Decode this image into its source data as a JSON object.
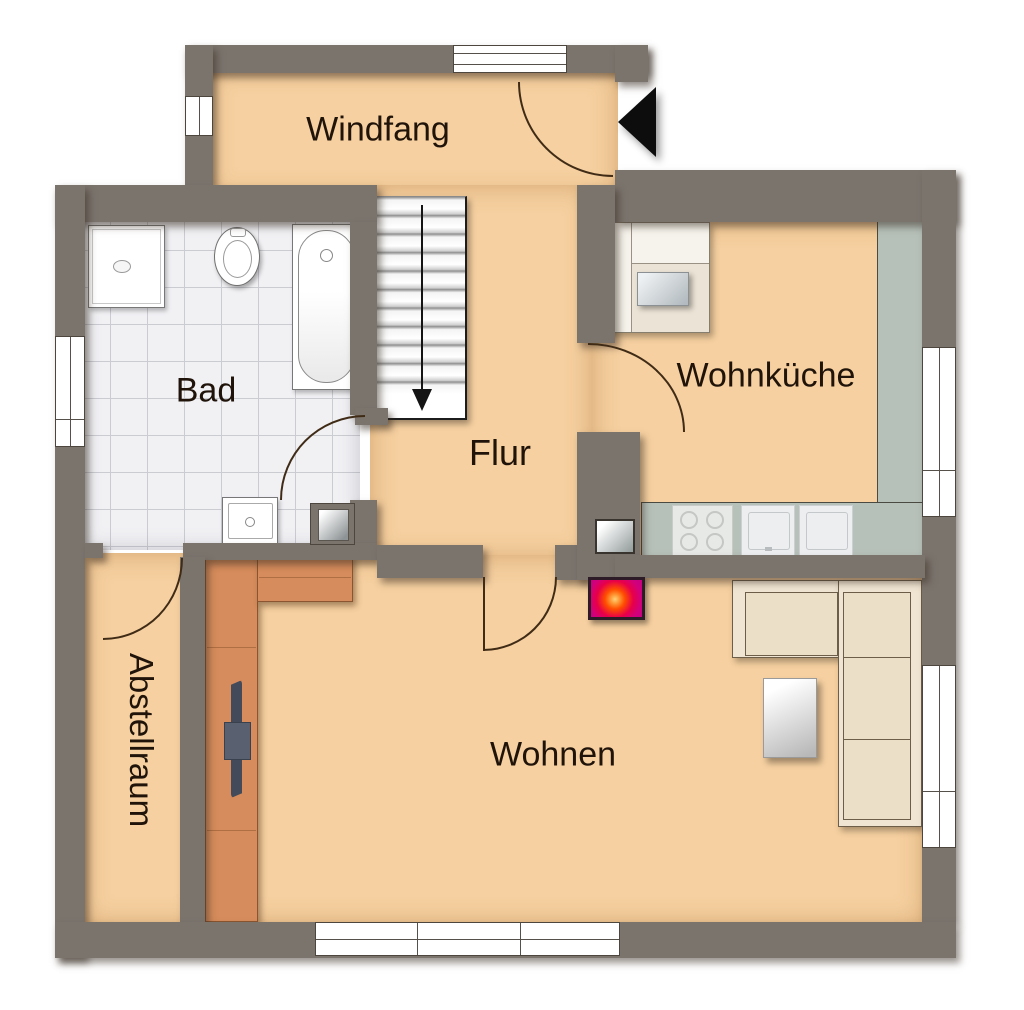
{
  "rooms": [
    {
      "id": "windfang",
      "label": "Windfang"
    },
    {
      "id": "bad",
      "label": "Bad"
    },
    {
      "id": "flur",
      "label": "Flur"
    },
    {
      "id": "wohnkueche",
      "label": "Wohnküche"
    },
    {
      "id": "wohnen",
      "label": "Wohnen"
    },
    {
      "id": "abstellraum",
      "label": "Abstellraum"
    }
  ],
  "colors": {
    "wall": "#7b746d",
    "floor": "#f6d0a0",
    "tile_floor": "#f1f1f4",
    "partition_terracotta": "#d68c5c",
    "kitchen_counter": "#b6c1b9",
    "sofa": "#f0e5d2",
    "fireplace_accent": "#d1007c",
    "entrance_arrow": "#0d0d0d"
  },
  "symbols": {
    "entrance_arrow": "left-pointing-triangle",
    "stair_direction": "down"
  },
  "fixtures": [
    "staircase",
    "shower",
    "toilet",
    "bathtub",
    "washbasin",
    "plumbing-niche",
    "corner-bench",
    "dining-table",
    "kitchen-counter",
    "cooktop",
    "sink-unit",
    "appliance-unit",
    "corner-sofa",
    "coffee-table",
    "tv-partition",
    "fireplace-stove"
  ]
}
